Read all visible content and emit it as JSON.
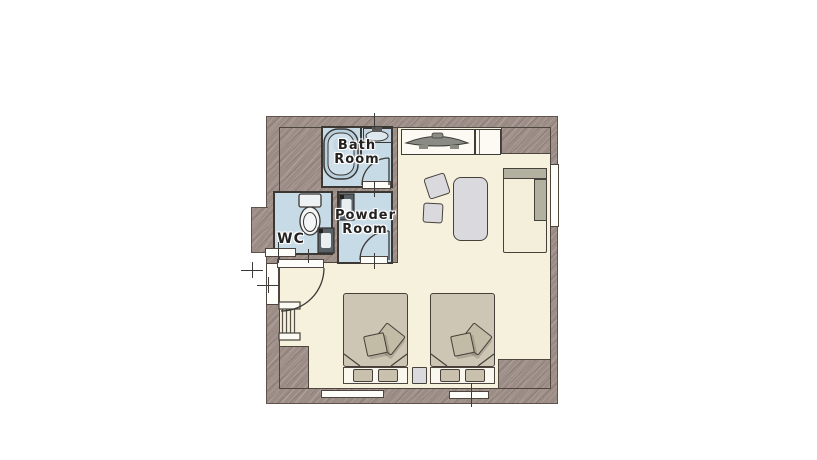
{
  "labels": {
    "bath_room": [
      "Bath",
      "Room"
    ],
    "powder_room": [
      "Powder",
      "Room"
    ],
    "wc": "WC"
  },
  "colors": {
    "wall": "#9c8c86",
    "floor": "#f5f1dc",
    "wet_room_floor": "#c7dbe7",
    "outline": "#3f3b38",
    "bed_duvet": "#cdc6b4",
    "sofa_accent": "#b2b1a0",
    "fixture_white": "#fcfaf2",
    "background": "#ffffff"
  },
  "fixtures": [
    "bathtub",
    "bath-sink",
    "toilet",
    "wc-sink",
    "powder-sink",
    "tv",
    "tv-console",
    "side-cabinet",
    "table",
    "chairs",
    "sofa",
    "twin-beds",
    "pillows",
    "cushions",
    "nightstand",
    "luggage-rack",
    "entrance-door",
    "door-swing-arcs",
    "windows"
  ]
}
